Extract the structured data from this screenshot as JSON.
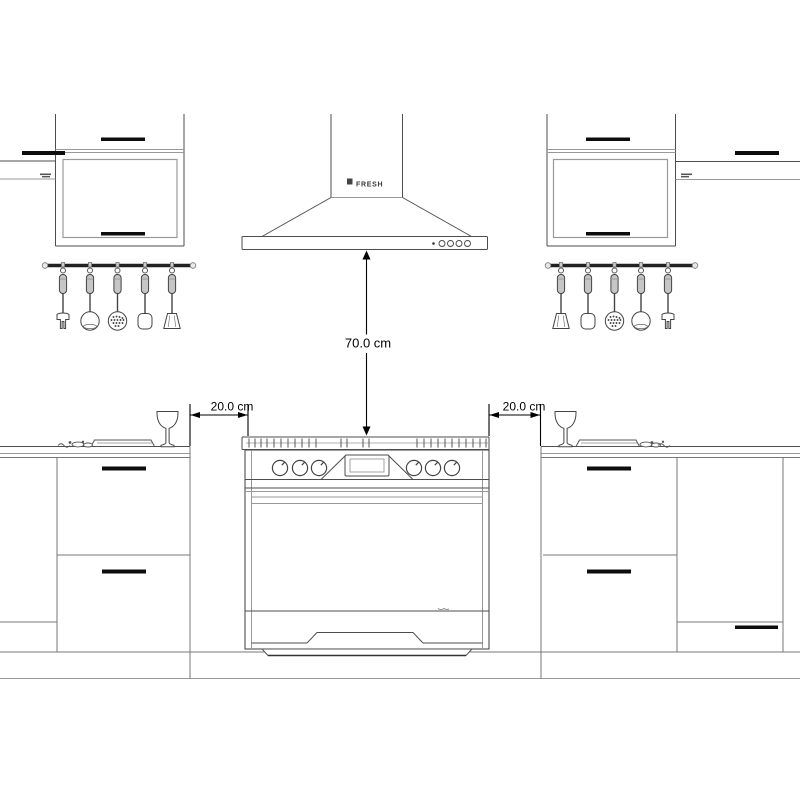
{
  "labels": {
    "hood_clearance": "70.0 cm",
    "left_clearance": "20.0 cm",
    "right_clearance": "20.0 cm",
    "hood_brand": "FRESH"
  },
  "colors": {
    "background": "#ffffff",
    "line": "#4d4d4d",
    "line_light": "#999999",
    "handle": "#0d0d0d",
    "dimension_text": "#000000"
  },
  "objects": [
    "range-hood",
    "gas-range",
    "left-wall-cabinet",
    "right-wall-cabinet",
    "left-base-cabinet",
    "right-base-cabinet",
    "left-utensil-rail",
    "right-utensil-rail",
    "wine-glass-left",
    "wine-glass-right",
    "serving-tray-left",
    "serving-tray-right"
  ]
}
